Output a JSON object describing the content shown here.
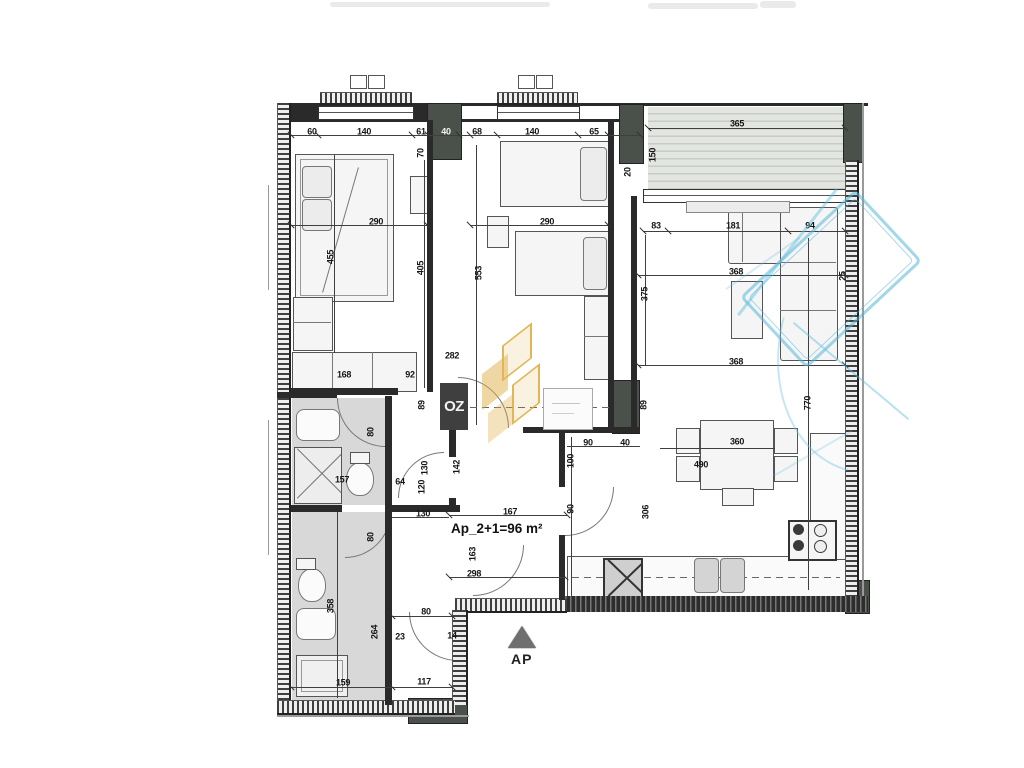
{
  "plan": {
    "area_label": "Ap_2+1=96 m²",
    "entrance_label": "AP",
    "watermark_text": "OZ",
    "accent_colors": {
      "watermark_orange": "#ddaa3c",
      "stamp_blue": "#56b6d8",
      "wall_dark": "#2a2a2a",
      "pillar_green": "#49514a"
    }
  },
  "dims": [
    {
      "t": "60",
      "x": 312,
      "y": 132
    },
    {
      "t": "140",
      "x": 364,
      "y": 132
    },
    {
      "t": "61",
      "x": 421,
      "y": 132
    },
    {
      "t": "40",
      "x": 446,
      "y": 132,
      "c": 1
    },
    {
      "t": "68",
      "x": 477,
      "y": 132
    },
    {
      "t": "140",
      "x": 532,
      "y": 132
    },
    {
      "t": "65",
      "x": 594,
      "y": 132
    },
    {
      "t": "70",
      "x": 421,
      "y": 153,
      "v": 1
    },
    {
      "t": "365",
      "x": 737,
      "y": 124
    },
    {
      "t": "150",
      "x": 653,
      "y": 155,
      "v": 1
    },
    {
      "t": "20",
      "x": 628,
      "y": 172,
      "v": 1
    },
    {
      "t": "290",
      "x": 376,
      "y": 222
    },
    {
      "t": "455",
      "x": 331,
      "y": 257,
      "v": 1
    },
    {
      "t": "405",
      "x": 421,
      "y": 268,
      "v": 1
    },
    {
      "t": "168",
      "x": 344,
      "y": 375
    },
    {
      "t": "92",
      "x": 410,
      "y": 375
    },
    {
      "t": "290",
      "x": 547,
      "y": 222
    },
    {
      "t": "553",
      "x": 479,
      "y": 273,
      "v": 1
    },
    {
      "t": "375",
      "x": 645,
      "y": 294,
      "v": 1
    },
    {
      "t": "282",
      "x": 452,
      "y": 356
    },
    {
      "t": "83",
      "x": 656,
      "y": 226
    },
    {
      "t": "181",
      "x": 733,
      "y": 226
    },
    {
      "t": "94",
      "x": 810,
      "y": 226
    },
    {
      "t": "368",
      "x": 736,
      "y": 272
    },
    {
      "t": "368",
      "x": 736,
      "y": 362
    },
    {
      "t": "360",
      "x": 737,
      "y": 442
    },
    {
      "t": "490",
      "x": 701,
      "y": 465
    },
    {
      "t": "90",
      "x": 588,
      "y": 443
    },
    {
      "t": "40",
      "x": 625,
      "y": 443
    },
    {
      "t": "100",
      "x": 571,
      "y": 461,
      "v": 1
    },
    {
      "t": "90",
      "x": 571,
      "y": 509,
      "v": 1
    },
    {
      "t": "306",
      "x": 646,
      "y": 512,
      "v": 1
    },
    {
      "t": "770",
      "x": 808,
      "y": 403,
      "v": 1
    },
    {
      "t": "25",
      "x": 843,
      "y": 276,
      "v": 1
    },
    {
      "t": "89",
      "x": 422,
      "y": 405,
      "v": 1
    },
    {
      "t": "89",
      "x": 644,
      "y": 405,
      "v": 1
    },
    {
      "t": "142",
      "x": 457,
      "y": 467,
      "v": 1
    },
    {
      "t": "130",
      "x": 425,
      "y": 468,
      "v": 1
    },
    {
      "t": "120",
      "x": 422,
      "y": 487,
      "v": 1
    },
    {
      "t": "167",
      "x": 510,
      "y": 512
    },
    {
      "t": "130",
      "x": 423,
      "y": 514
    },
    {
      "t": "163",
      "x": 473,
      "y": 554,
      "v": 1
    },
    {
      "t": "298",
      "x": 474,
      "y": 574
    },
    {
      "t": "80",
      "x": 371,
      "y": 432,
      "v": 1
    },
    {
      "t": "157",
      "x": 342,
      "y": 480
    },
    {
      "t": "64",
      "x": 400,
      "y": 482
    },
    {
      "t": "80",
      "x": 371,
      "y": 537,
      "v": 1
    },
    {
      "t": "358",
      "x": 331,
      "y": 606,
      "v": 1
    },
    {
      "t": "264",
      "x": 375,
      "y": 632,
      "v": 1
    },
    {
      "t": "159",
      "x": 343,
      "y": 683
    },
    {
      "t": "80",
      "x": 426,
      "y": 612
    },
    {
      "t": "23",
      "x": 400,
      "y": 637
    },
    {
      "t": "14",
      "x": 452,
      "y": 636
    },
    {
      "t": "117",
      "x": 424,
      "y": 682
    }
  ]
}
